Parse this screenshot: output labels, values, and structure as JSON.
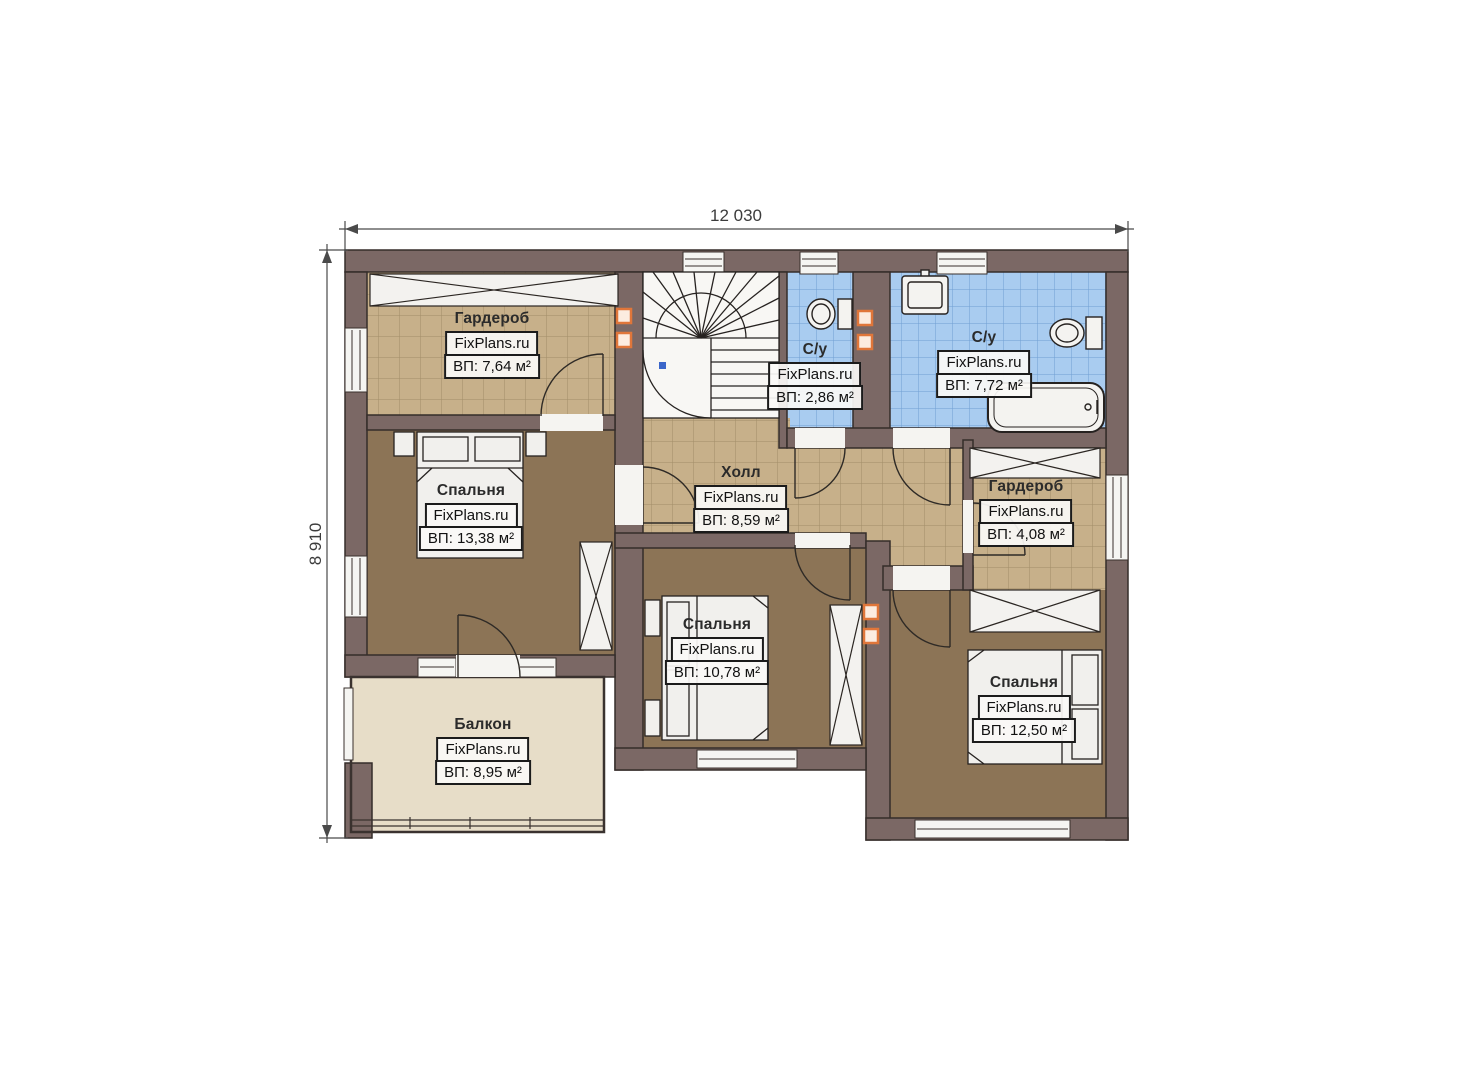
{
  "page": {
    "type": "floor-plan",
    "background": "#ffffff"
  },
  "dimensions": {
    "width_label": "12 030",
    "height_label": "8 910"
  },
  "watermark": "FixPlans.ru",
  "rooms": [
    {
      "id": "wardrobe-top-left",
      "label": "Гардероб",
      "watermark": "FixPlans.ru",
      "area": "ВП: 7,64 м²"
    },
    {
      "id": "bedroom-left",
      "label": "Спальня",
      "watermark": "FixPlans.ru",
      "area": "ВП: 13,38 м²"
    },
    {
      "id": "bathroom-small",
      "label": "С/у",
      "watermark": "FixPlans.ru",
      "area": "ВП: 2,86 м²"
    },
    {
      "id": "bathroom-large",
      "label": "С/у",
      "watermark": "FixPlans.ru",
      "area": "ВП: 7,72 м²"
    },
    {
      "id": "hall",
      "label": "Холл",
      "watermark": "FixPlans.ru",
      "area": "ВП: 8,59 м²"
    },
    {
      "id": "wardrobe-right",
      "label": "Гардероб",
      "watermark": "FixPlans.ru",
      "area": "ВП: 4,08 м²"
    },
    {
      "id": "bedroom-middle",
      "label": "Спальня",
      "watermark": "FixPlans.ru",
      "area": "ВП: 10,78 м²"
    },
    {
      "id": "bedroom-right",
      "label": "Спальня",
      "watermark": "FixPlans.ru",
      "area": "ВП: 12,50 м²"
    },
    {
      "id": "balcony",
      "label": "Балкон",
      "watermark": "FixPlans.ru",
      "area": "ВП: 8,95 м²"
    }
  ],
  "colors": {
    "wall": "#7b6865",
    "tile_tan": "#c7b08a",
    "tile_blue": "#a9ccf0",
    "floor_brown": "#8c7456",
    "balcony_floor": "#e7ddc8",
    "vent_orange": "#e0763a"
  }
}
